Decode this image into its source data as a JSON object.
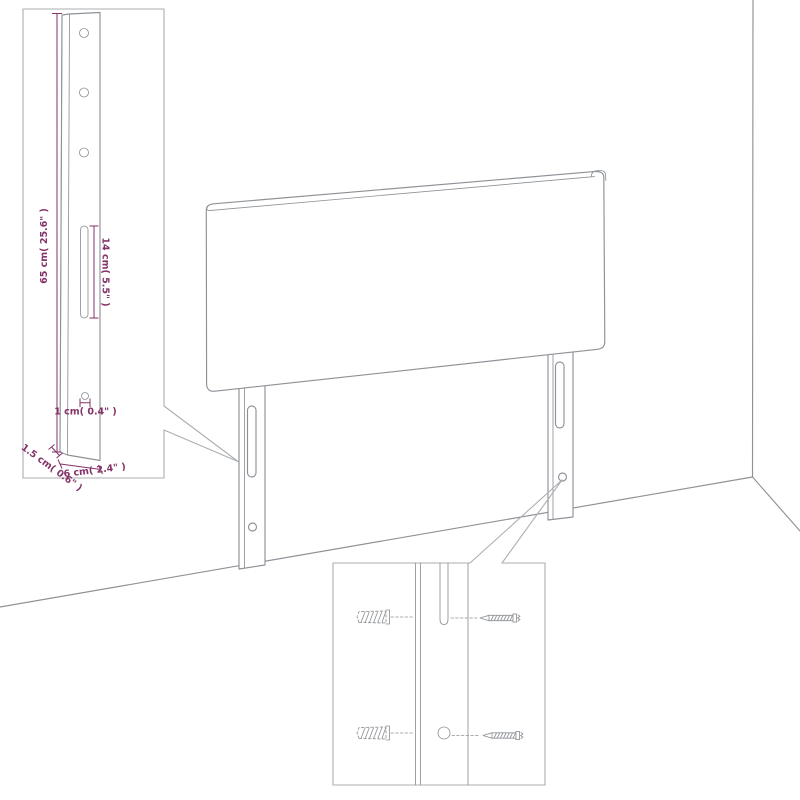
{
  "diagram": {
    "type": "product-assembly-dimension-diagram",
    "dimension_labels": {
      "leg_height": "65 cm( 25.6\" )",
      "slot_length": "14 cm( 5.5\" )",
      "hole_diameter": "1 cm( 0.4\" )",
      "side_thickness": "1.5 cm( 0.6\" )",
      "leg_width": "6 cm( 2.4\" )"
    },
    "icons": [
      "wall-plug-icon",
      "screw-icon",
      "mount-hole",
      "mount-slot"
    ],
    "colors": {
      "outline": "#8e9297",
      "inset_border": "#abaeb2",
      "dimension": "#833368",
      "background": "#ffffff"
    }
  }
}
